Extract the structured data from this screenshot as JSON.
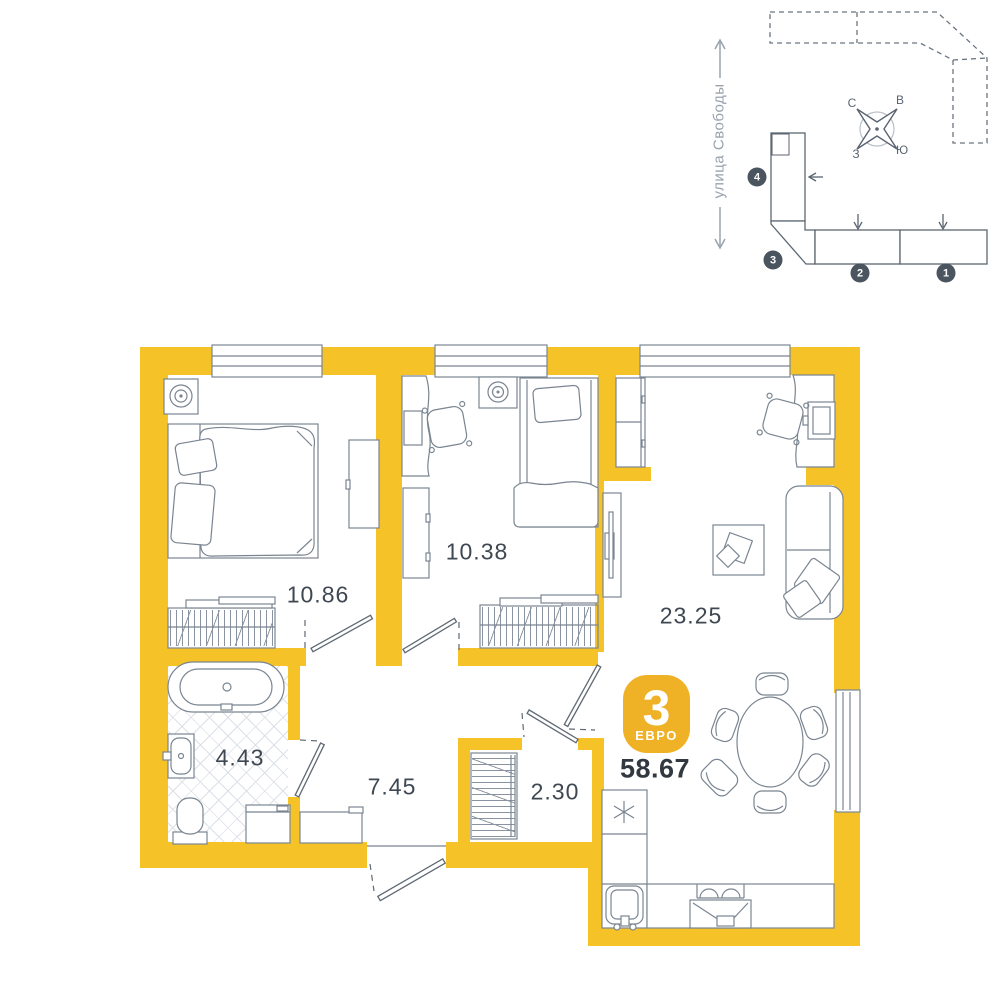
{
  "site_plan": {
    "street_label": "улица Свободы",
    "building_numbers": [
      "1",
      "2",
      "3",
      "4"
    ],
    "compass": {
      "north": "С",
      "east": "В",
      "west": "З",
      "south": "Ю"
    }
  },
  "apartment": {
    "badge": {
      "rooms": "3",
      "type": "ЕВРО"
    },
    "total_area": "58.67",
    "rooms": [
      {
        "name": "bedroom-1",
        "area": "10.86"
      },
      {
        "name": "bedroom-2",
        "area": "10.38"
      },
      {
        "name": "living-kitchen",
        "area": "23.25"
      },
      {
        "name": "bathroom",
        "area": "4.43"
      },
      {
        "name": "hallway",
        "area": "7.45"
      },
      {
        "name": "closet",
        "area": "2.30"
      }
    ]
  },
  "colors": {
    "wall_yellow": "#F5C227",
    "badge_yellow": "#EFB125",
    "furniture_line": "#7A8591",
    "dark_text": "#3F4852",
    "site_line": "#5C6670",
    "muted_gray": "#98A2AD"
  }
}
